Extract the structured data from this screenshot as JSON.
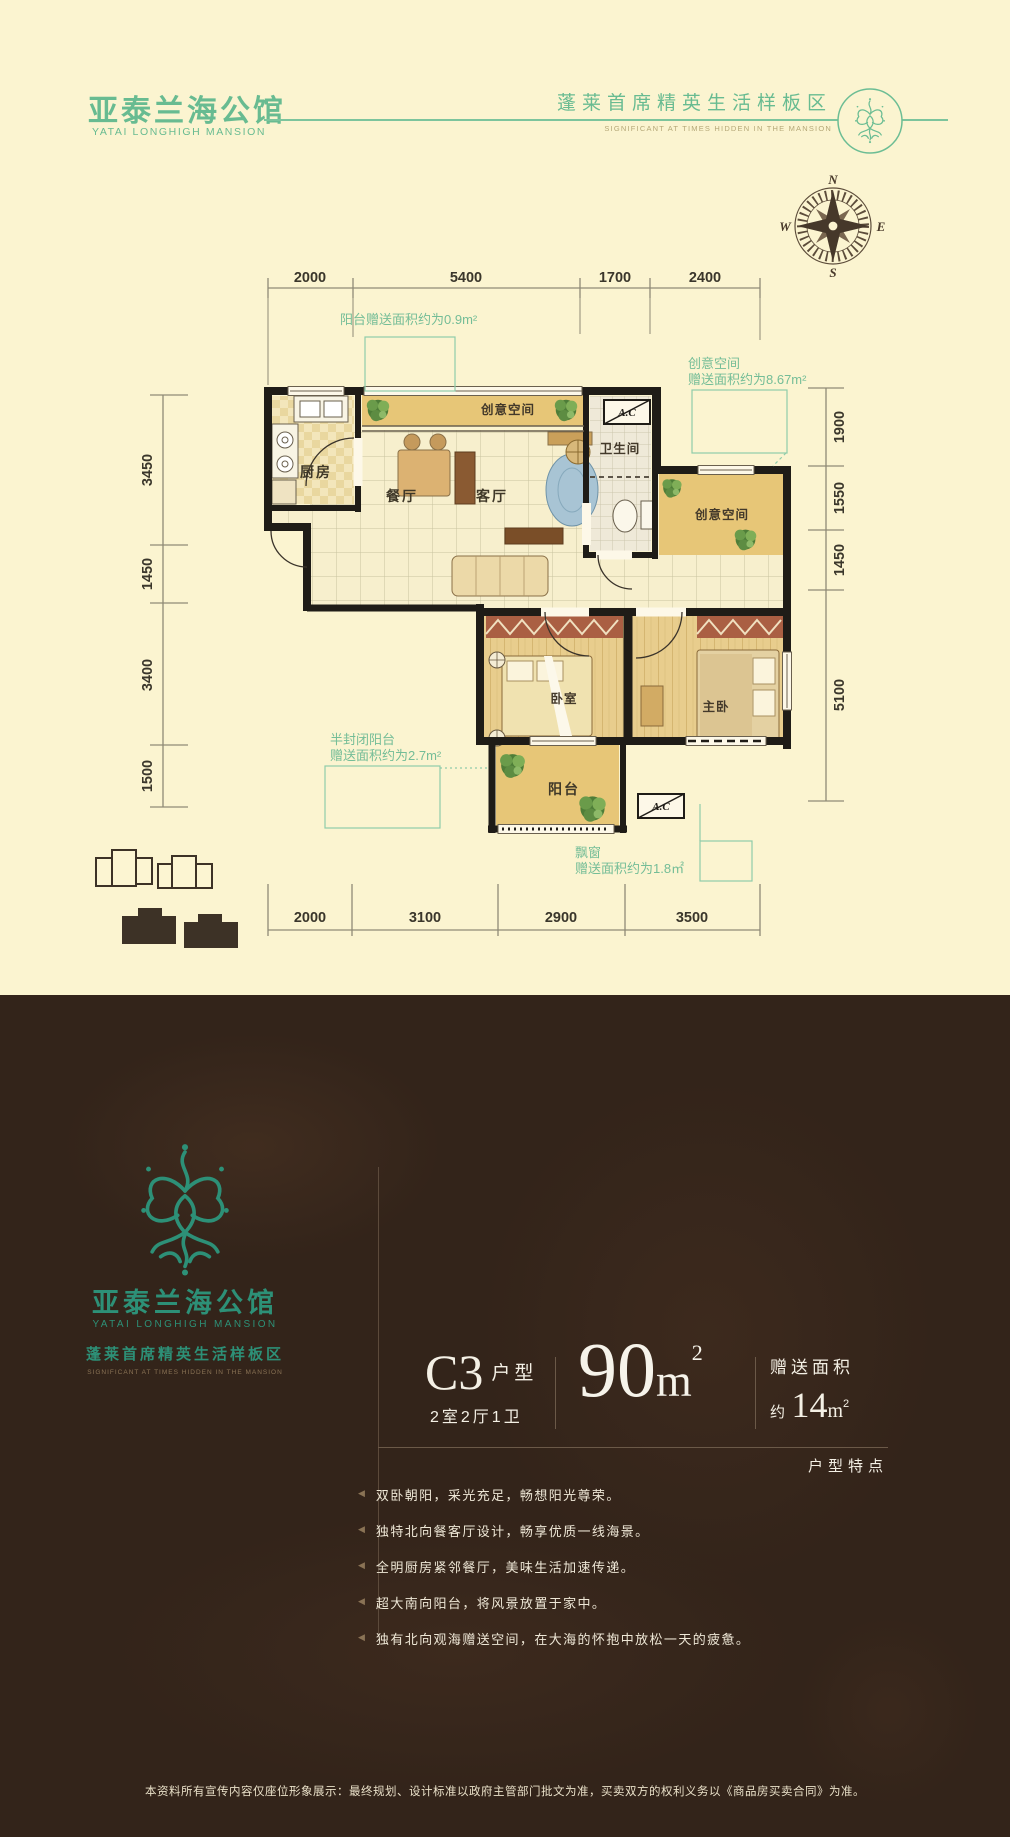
{
  "header": {
    "brand_cn": "亚泰兰海公馆",
    "brand_en": "YATAI LONGHIGH MANSION",
    "tagline_cn": "蓬莱首席精英生活样板区",
    "tagline_en": "SIGNIFICANT AT TIMES HIDDEN IN THE MANSION"
  },
  "compass": {
    "n": "N",
    "e": "E",
    "s": "S",
    "w": "W"
  },
  "plan": {
    "dims_top": [
      "2000",
      "5400",
      "1700",
      "2400"
    ],
    "dims_bottom": [
      "2000",
      "3100",
      "2900",
      "3500"
    ],
    "dims_left": [
      "3450",
      "1450",
      "3400",
      "1500"
    ],
    "dims_right": [
      "1900",
      "1550",
      "1450",
      "5100"
    ],
    "rooms": {
      "kitchen": "厨房",
      "dining": "餐厅",
      "living": "客厅",
      "bath": "卫生间",
      "creative1": "创意空间",
      "creative2": "创意空间",
      "bedroom": "卧室",
      "master": "主卧",
      "balcony": "阳台"
    },
    "ac_label": "A.C",
    "annotations": {
      "balcony_gift": "阳台赠送面积约为0.9m²",
      "creative_gift_1": "创意空间",
      "creative_gift_2": "赠送面积约为8.67m²",
      "semi_balcony_1": "半封闭阳台",
      "semi_balcony_2": "赠送面积约为2.7m²",
      "bay_window_1": "飘窗",
      "bay_window_2": "赠送面积约为1.8㎡"
    }
  },
  "panel": {
    "brand_cn": "亚泰兰海公馆",
    "brand_en": "YATAI LONGHIGH MANSION",
    "tagline_cn": "蓬莱首席精英生活样板区",
    "tagline_en": "SIGNIFICANT AT TIMES HIDDEN IN THE MANSION",
    "unit_code": "C3",
    "unit_type_label": "户型",
    "unit_layout": "2室2厅1卫",
    "area_number": "90",
    "area_unit": "m",
    "area_sup": "2",
    "gift_label": "赠送面积",
    "gift_prefix": "约",
    "gift_number": "14",
    "gift_unit": "m",
    "gift_sup": "2",
    "features_title": "户型特点",
    "feature_marker": "◀",
    "features": [
      "双卧朝阳，采光充足，畅想阳光尊荣。",
      "独特北向餐客厅设计，畅享优质一线海景。",
      "全明厨房紧邻餐厅，美味生活加速传递。",
      "超大南向阳台，将风景放置于家中。",
      "独有北向观海赠送空间，在大海的怀抱中放松一天的疲惫。"
    ]
  },
  "footer": {
    "disclaimer": "本资料所有宣传内容仅座位形象展示：最终规划、设计标准以政府主管部门批文为准，买卖双方的权利义务以《商品房买卖合同》为准。"
  }
}
